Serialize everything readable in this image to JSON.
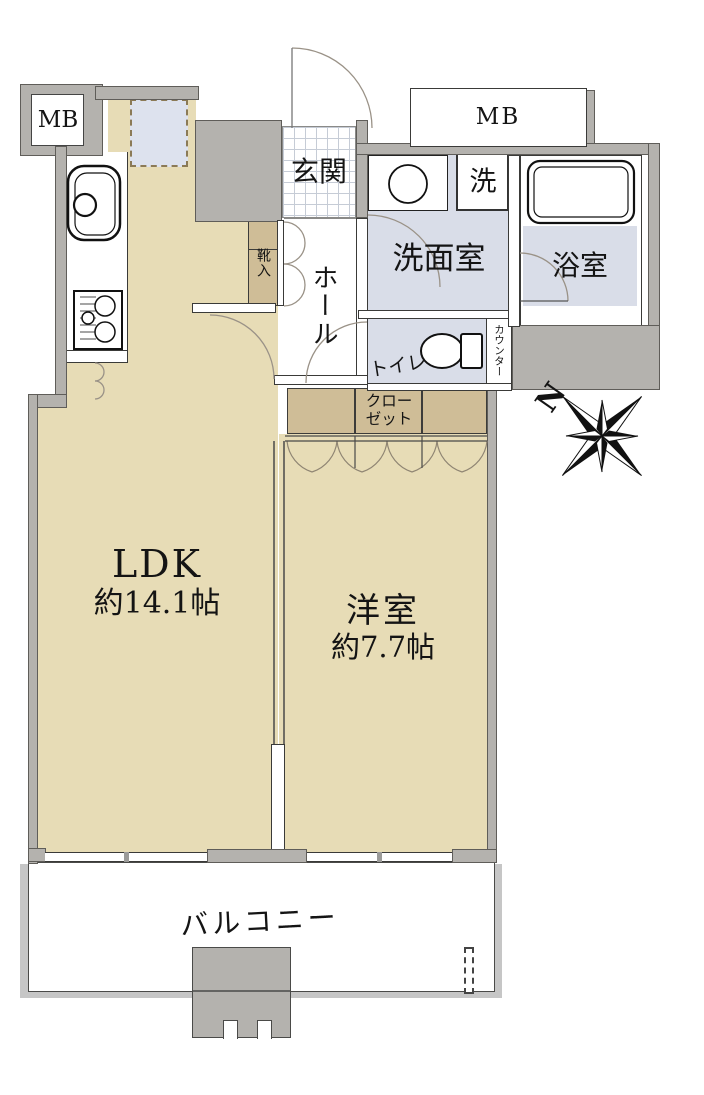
{
  "floor_plan": {
    "labels": {
      "mb_left": "MB",
      "mb_right": "MB",
      "entrance": "玄関",
      "hall": "ホール",
      "shoe_cabinet": "靴入",
      "washroom": "洗面室",
      "washer": "洗",
      "bathroom": "浴室",
      "toilet": "トイレ",
      "counter": "カウンター",
      "closet": "クローゼット",
      "balcony": "バルコニー",
      "north": "N"
    },
    "rooms": {
      "ldk": {
        "name": "LDK",
        "size": "約14.1帖"
      },
      "bedroom": {
        "name": "洋室",
        "size": "約7.7帖"
      }
    },
    "colors": {
      "floor": "#e7dcb6",
      "wet_floor": "#d9dde8",
      "storage": "#cfbd97",
      "wall": "#b4b2ae",
      "appliance_nook": "#dde2ee"
    }
  }
}
